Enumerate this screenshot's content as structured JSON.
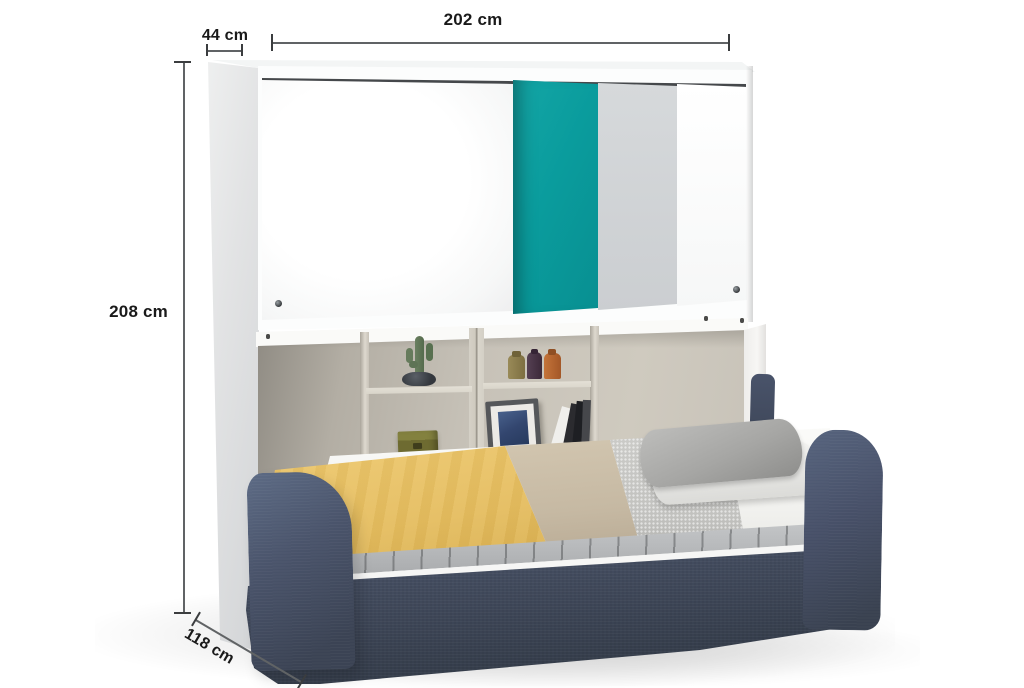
{
  "annotations": {
    "width": {
      "label": "202 cm"
    },
    "cabinet_depth": {
      "label": "44 cm"
    },
    "height": {
      "label": "208 cm"
    },
    "bed_depth": {
      "label": "118 cm"
    }
  },
  "palette": {
    "accent_teal_door": "#0a9c9d",
    "grey_door": "#ced1d4",
    "cabinet_white": "#fcfdfd",
    "shelf_interior_greige": "#c8c3b9",
    "sofa_navy_fabric": "#3e4757",
    "blanket_yellow": "#e5bd5f",
    "blanket_beige": "#c6b9a3",
    "blanket_grey": "#c6c6c3",
    "mattress_white": "#f4f4f2",
    "pillow_grey": "#a6a6a4",
    "dimension_line": "#606365",
    "dimension_text": "#1a1a1a",
    "background": "#ffffff"
  }
}
